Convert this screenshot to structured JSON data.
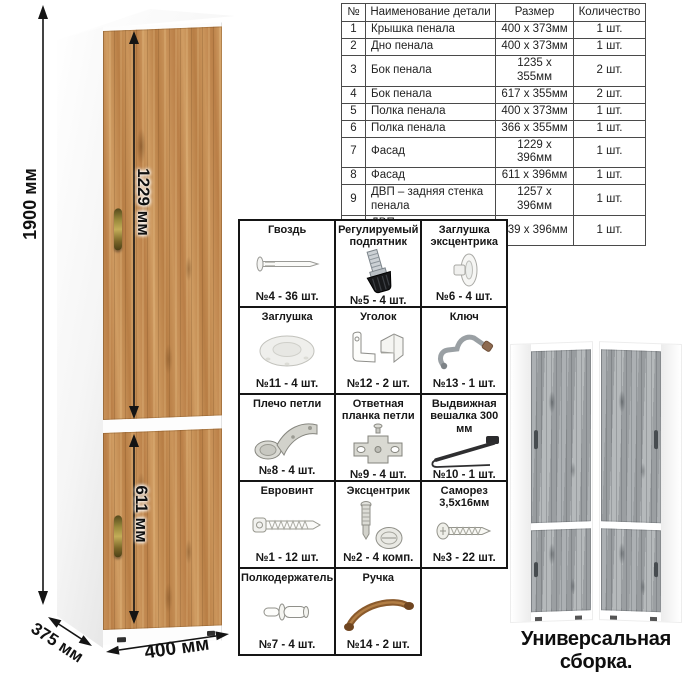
{
  "cabinet": {
    "dim_height": "1900 мм",
    "dim_upper_door": "1229 мм",
    "dim_lower_door": "611 мм",
    "dim_depth": "375 мм",
    "dim_width": "400 мм"
  },
  "parts_table": {
    "headers": [
      "№",
      "Наименование детали",
      "Размер",
      "Количество"
    ],
    "rows": [
      [
        "1",
        "Крышка пенала",
        "400 х 373мм",
        "1 шт."
      ],
      [
        "2",
        "Дно пенала",
        "400 х 373мм",
        "1 шт."
      ],
      [
        "3",
        "Бок пенала",
        "1235 х 355мм",
        "2 шт."
      ],
      [
        "4",
        "Бок пенала",
        "617 х 355мм",
        "2 шт."
      ],
      [
        "5",
        "Полка пенала",
        "400 х 373мм",
        "1 шт."
      ],
      [
        "6",
        "Полка пенала",
        "366 х 355мм",
        "1 шт."
      ],
      [
        "7",
        "Фасад",
        "1229 х 396мм",
        "1 шт."
      ],
      [
        "8",
        "Фасад",
        "611 х 396мм",
        "1 шт."
      ],
      [
        "9",
        "ДВП – задняя стенка пенала",
        "1257 х 396мм",
        "1 шт."
      ],
      [
        "10",
        "ДВП – задняя стенка пенала",
        "639 х 396мм",
        "1 шт."
      ]
    ]
  },
  "hardware": {
    "items": [
      {
        "name": "Гвоздь",
        "count": "№4 - 36 шт.",
        "icon": "nail-icon"
      },
      {
        "name": "Регулируемый подпятник",
        "count": "№5 - 4 шт.",
        "icon": "adjustable-foot-icon"
      },
      {
        "name": "Заглушка эксцентрика",
        "count": "№6 - 4 шт.",
        "icon": "cam-cap-icon"
      },
      {
        "name": "Заглушка",
        "count": "№11 - 4 шт.",
        "icon": "cap-icon"
      },
      {
        "name": "Уголок",
        "count": "№12 - 2 шт.",
        "icon": "corner-bracket-icon"
      },
      {
        "name": "Ключ",
        "count": "№13 - 1 шт.",
        "icon": "key-icon"
      },
      {
        "name": "Плечо петли",
        "count": "№8 - 4 шт.",
        "icon": "hinge-arm-icon"
      },
      {
        "name": "Ответная планка петли",
        "count": "№9 - 4 шт.",
        "icon": "hinge-plate-icon"
      },
      {
        "name": "Выдвижная вешалка 300 мм",
        "count": "№10 - 1 шт.",
        "icon": "pullout-hanger-icon"
      },
      {
        "name": "Евровинт",
        "count": "№1 - 12 шт.",
        "icon": "euro-screw-icon"
      },
      {
        "name": "Эксцентрик",
        "count": "№2 - 4 комп.",
        "icon": "cam-lock-icon"
      },
      {
        "name": "Саморез 3,5х16мм",
        "count": "№3 - 22 шт.",
        "icon": "self-tapping-screw-icon"
      },
      {
        "name": "Полкодержатель",
        "count": "№7 - 4 шт.",
        "icon": "shelf-pin-icon"
      },
      {
        "name": "Ручка",
        "count": "№14 - 2 шт.",
        "icon": "handle-icon"
      }
    ]
  },
  "footer": {
    "caption": "Универсальная сборка."
  },
  "colors": {
    "oak_wood": "#c08a4f",
    "gray_wood": "#a2a6a8",
    "brass_handle": "#9a8a3c",
    "dimension_line": "#141414",
    "table_border": "#4a4a4a"
  }
}
